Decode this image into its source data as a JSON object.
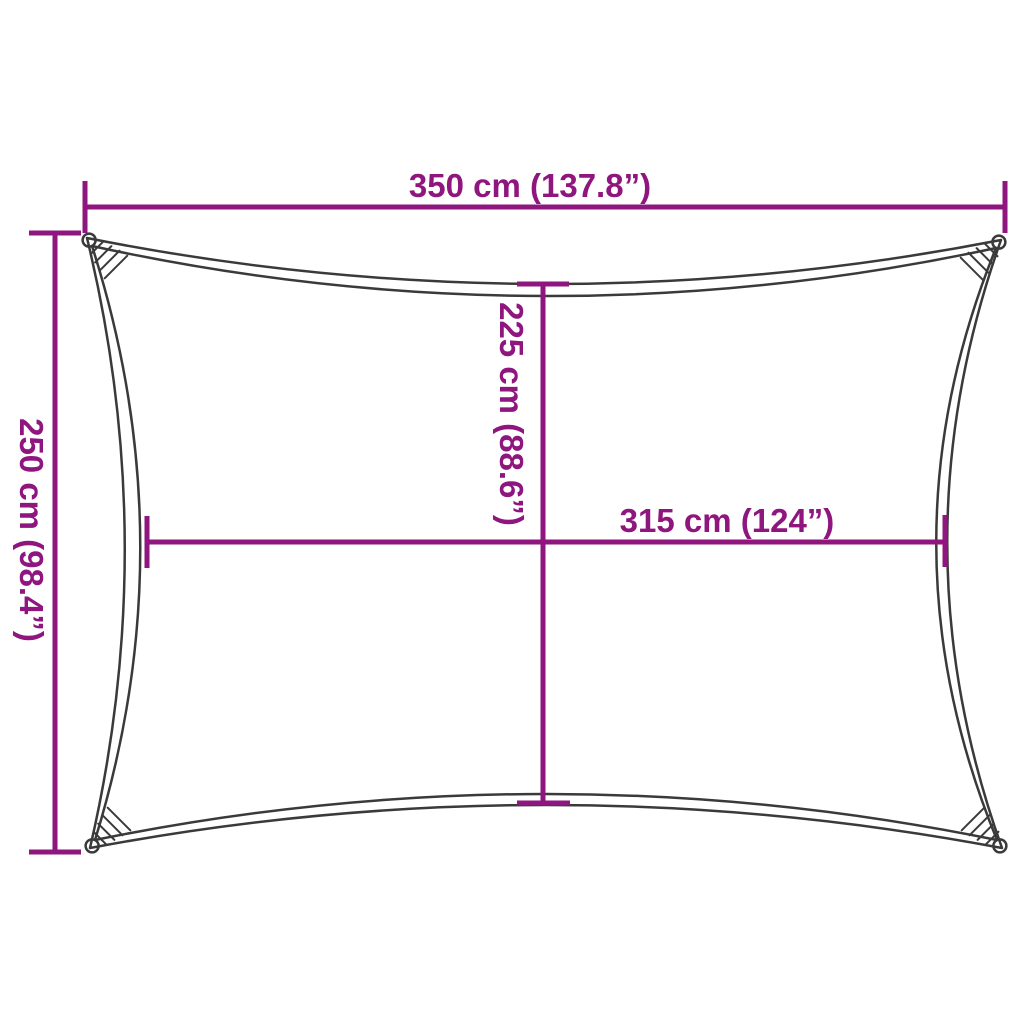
{
  "diagram": {
    "type": "shade-sail-dimension-diagram",
    "dimensions": {
      "width_overall": {
        "label": "350 cm (137.8”)",
        "orientation": "horizontal-top"
      },
      "height_overall": {
        "label": "250 cm (98.4”)",
        "orientation": "vertical-left"
      },
      "height_inner": {
        "label": "225 cm (88.6”)",
        "orientation": "vertical-center"
      },
      "width_inner": {
        "label": "315 cm (124”)",
        "orientation": "horizontal-center"
      }
    },
    "colors": {
      "dimension_accent": "#8F157F",
      "sail_outline": "#3A3A3A",
      "background": "#FFFFFF"
    }
  }
}
